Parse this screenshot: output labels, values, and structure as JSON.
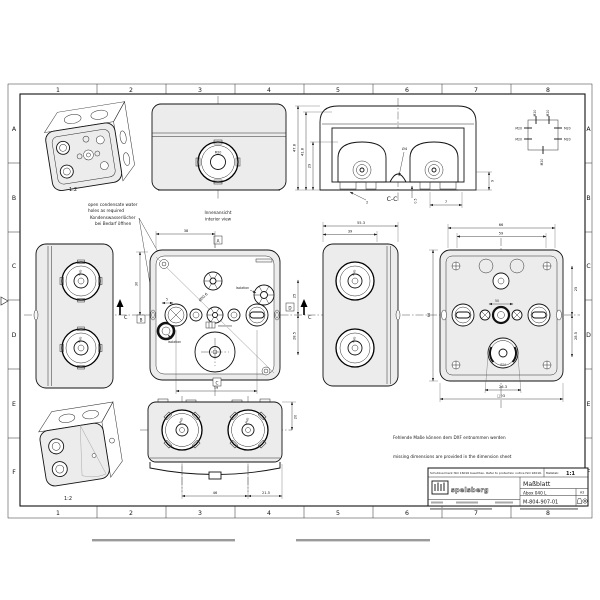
{
  "sheet": {
    "grid": {
      "columns": [
        "1",
        "2",
        "3",
        "4",
        "5",
        "6",
        "7",
        "8"
      ],
      "rows": [
        "A",
        "B",
        "C",
        "D",
        "E",
        "F"
      ]
    }
  },
  "labels": {
    "m20": "M20",
    "scale_small": "1:2",
    "section_name": "C-C",
    "section_arrow": "C",
    "isolation": "Isolation",
    "view_markers": {
      "top": "A",
      "left": "B",
      "right": "D",
      "bottom": "C"
    }
  },
  "notes": {
    "condensate_en1": "open condensate water",
    "condensate_en2": "holes as required",
    "condensate_de1": "Kondenswasserlöcher",
    "condensate_de2": "bei Bedarf öffnen",
    "interior_de": "Innenansicht",
    "interior_en": "interior view",
    "missing_de": "Fehlende Maße können dem DXF entnommen werden",
    "missing_en": "missing dimensions are provided in the dimension sheet"
  },
  "dims": {
    "section": {
      "outer_h": "47.8",
      "inner_h": "41.8",
      "dome_h": "29",
      "hole": "Ø4",
      "wall": "2",
      "gap": "0.5",
      "foot": "7",
      "skirt": "9"
    },
    "interior": {
      "top": "38",
      "left": "30",
      "small": "5",
      "diag": "Ø50.6",
      "bottom": "59",
      "right_top": "25",
      "right_bottom": "28.5"
    },
    "side": {
      "depth": "55.3",
      "body": "39"
    },
    "rear": {
      "w_outer": "66",
      "w_inner": "59",
      "h_left": "66",
      "r_top": "25",
      "r_bottom": "28.5",
      "center": "50",
      "b_inner": "26.3",
      "b_outer": "□93",
      "hole": "Ø24"
    },
    "bottom": {
      "top": "59",
      "right": "20",
      "left_span": "46",
      "right_span": "21.5"
    }
  },
  "title_block": {
    "protection": "Schutzvermerk ISO 16016 beachten. Refer to protection notice ISO 16016.",
    "scale_label": "Maßstab:",
    "scale_value": "1:1",
    "brand": "spelsberg",
    "doc_type": "Maßblatt",
    "product": "Abox 040 L",
    "doc_number": "M-804-907-01",
    "format": "A3"
  }
}
